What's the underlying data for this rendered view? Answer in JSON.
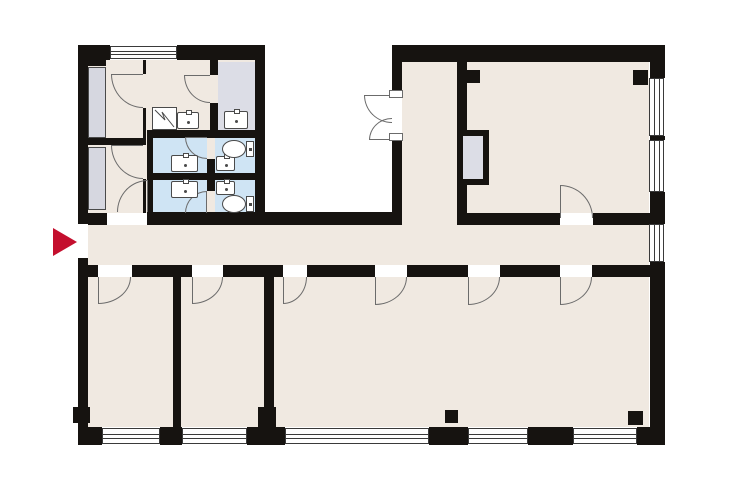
{
  "meta": {
    "title": "office-floor-plan",
    "canvas": {
      "w": 740,
      "h": 493
    }
  },
  "palette": {
    "wall": "#161310",
    "floor": "#f0e9e1",
    "wet": "#cfe4f4",
    "gray": "#dcdde6",
    "cabinet": "#d6d7e0",
    "outline": "#6b6b6b",
    "window_line": "#3a3a3a",
    "fixture": "#4a4a4a",
    "arrow": "#c40f2e",
    "white": "#ffffff"
  },
  "rooms": [
    {
      "name": "wing-a-floor",
      "x": 88,
      "y": 60,
      "w": 167,
      "h": 153,
      "fill": "floor"
    },
    {
      "name": "gray-washroom",
      "x": 218,
      "y": 62,
      "w": 37,
      "h": 68,
      "fill": "gray"
    },
    {
      "name": "wc-anteroom-1",
      "x": 153,
      "y": 138,
      "w": 54,
      "h": 35,
      "fill": "wet"
    },
    {
      "name": "wc-cabin-1",
      "x": 215,
      "y": 138,
      "w": 40,
      "h": 35,
      "fill": "wet"
    },
    {
      "name": "wc-anteroom-2",
      "x": 153,
      "y": 180,
      "w": 54,
      "h": 33,
      "fill": "wet"
    },
    {
      "name": "wc-cabin-2",
      "x": 215,
      "y": 180,
      "w": 40,
      "h": 33,
      "fill": "wet"
    },
    {
      "name": "north-lobby",
      "x": 402,
      "y": 62,
      "w": 55,
      "h": 163,
      "fill": "floor"
    },
    {
      "name": "meeting-room",
      "x": 467,
      "y": 62,
      "w": 182,
      "h": 151,
      "fill": "floor"
    },
    {
      "name": "corridor",
      "x": 88,
      "y": 225,
      "w": 561,
      "h": 40,
      "fill": "floor"
    },
    {
      "name": "office-1",
      "x": 88,
      "y": 277,
      "w": 85,
      "h": 150,
      "fill": "floor"
    },
    {
      "name": "office-2",
      "x": 181,
      "y": 277,
      "w": 83,
      "h": 150,
      "fill": "floor"
    },
    {
      "name": "open-office",
      "x": 274,
      "y": 277,
      "w": 375,
      "h": 150,
      "fill": "floor"
    }
  ],
  "walls": [
    [
      78,
      45,
      10,
      179
    ],
    [
      78,
      258,
      10,
      187
    ],
    [
      78,
      45,
      28,
      21
    ],
    [
      78,
      45,
      32,
      15
    ],
    [
      177,
      45,
      88,
      15
    ],
    [
      255,
      45,
      10,
      180
    ],
    [
      392,
      45,
      10,
      50
    ],
    [
      392,
      140,
      10,
      85
    ],
    [
      392,
      45,
      273,
      17
    ],
    [
      650,
      45,
      15,
      33
    ],
    [
      650,
      136,
      15,
      4
    ],
    [
      650,
      192,
      15,
      32
    ],
    [
      650,
      262,
      15,
      183
    ],
    [
      78,
      213,
      29,
      12
    ],
    [
      150,
      212,
      242,
      13
    ],
    [
      457,
      62,
      10,
      68
    ],
    [
      457,
      185,
      10,
      40
    ],
    [
      457,
      213,
      103,
      12
    ],
    [
      593,
      213,
      57,
      12
    ],
    [
      78,
      265,
      20,
      12
    ],
    [
      132,
      265,
      60,
      12
    ],
    [
      223,
      265,
      60,
      12
    ],
    [
      307,
      265,
      68,
      12
    ],
    [
      407,
      265,
      61,
      12
    ],
    [
      500,
      265,
      60,
      12
    ],
    [
      592,
      265,
      73,
      12
    ],
    [
      173,
      277,
      8,
      150
    ],
    [
      264,
      277,
      10,
      150
    ],
    [
      78,
      427,
      24,
      18
    ],
    [
      160,
      427,
      22,
      18
    ],
    [
      247,
      427,
      38,
      18
    ],
    [
      429,
      427,
      39,
      18
    ],
    [
      528,
      427,
      45,
      18
    ],
    [
      637,
      427,
      28,
      18
    ],
    [
      147,
      130,
      118,
      8
    ],
    [
      147,
      138,
      6,
      87
    ],
    [
      207,
      130,
      8,
      7
    ],
    [
      207,
      159,
      8,
      32
    ],
    [
      207,
      213,
      8,
      12
    ],
    [
      147,
      173,
      118,
      7
    ],
    [
      210,
      60,
      8,
      15
    ],
    [
      210,
      103,
      8,
      27
    ],
    [
      143,
      60,
      3,
      14
    ],
    [
      143,
      108,
      3,
      37
    ],
    [
      143,
      179,
      3,
      34
    ],
    [
      78,
      138,
      65,
      7
    ],
    [
      457,
      130,
      32,
      55
    ]
  ],
  "shaft_inner": [
    463,
    136,
    20,
    43
  ],
  "cabinets": [
    [
      88,
      67,
      18,
      71
    ],
    [
      88,
      147,
      18,
      63
    ]
  ],
  "openings": [
    [
      78,
      224,
      10,
      34
    ]
  ],
  "windows": [
    [
      110,
      46,
      67,
      13,
      "h"
    ],
    [
      649,
      78,
      15,
      58,
      "v"
    ],
    [
      649,
      140,
      15,
      52,
      "v"
    ],
    [
      649,
      224,
      15,
      38,
      "v"
    ],
    [
      102,
      428,
      58,
      16,
      "h"
    ],
    [
      182,
      428,
      65,
      16,
      "h"
    ],
    [
      285,
      428,
      144,
      16,
      "h"
    ],
    [
      468,
      428,
      60,
      16,
      "h"
    ],
    [
      573,
      428,
      64,
      16,
      "h"
    ]
  ],
  "doors": {
    "arcs": [
      [
        111,
        74,
        32,
        34,
        "tr"
      ],
      [
        111,
        145,
        32,
        34,
        "tr"
      ],
      [
        117,
        180,
        31,
        32,
        "br"
      ],
      [
        184,
        75,
        26,
        28,
        "tr"
      ],
      [
        185,
        137,
        22,
        22,
        "tr"
      ],
      [
        185,
        191,
        22,
        22,
        "br"
      ],
      [
        364,
        95,
        28,
        28,
        "tr"
      ],
      [
        369,
        118,
        23,
        22,
        "br"
      ],
      [
        560,
        185,
        33,
        33,
        "bl"
      ],
      [
        98,
        277,
        33,
        27,
        "tl"
      ],
      [
        192,
        277,
        31,
        27,
        "tl"
      ],
      [
        283,
        277,
        24,
        27,
        "tl"
      ],
      [
        375,
        277,
        32,
        28,
        "tl"
      ],
      [
        468,
        277,
        32,
        28,
        "tl"
      ],
      [
        560,
        277,
        32,
        28,
        "tl"
      ]
    ],
    "leaves": [
      [
        111,
        74,
        32,
        1
      ],
      [
        111,
        145,
        32,
        1
      ],
      [
        147,
        180,
        1,
        32
      ],
      [
        184,
        75,
        26,
        1
      ],
      [
        185,
        137,
        22,
        1
      ],
      [
        206,
        191,
        1,
        22
      ],
      [
        364,
        95,
        28,
        1
      ],
      [
        369,
        139,
        23,
        1
      ],
      [
        560,
        185,
        1,
        33
      ],
      [
        98,
        277,
        1,
        27
      ],
      [
        192,
        277,
        1,
        27
      ],
      [
        283,
        277,
        1,
        27
      ],
      [
        375,
        277,
        1,
        28
      ],
      [
        468,
        277,
        1,
        28
      ],
      [
        560,
        277,
        1,
        28
      ]
    ],
    "panels": [
      [
        389,
        90,
        14,
        8
      ],
      [
        389,
        133,
        14,
        8
      ]
    ]
  },
  "pillars": [
    [
      466,
      70,
      14,
      13
    ],
    [
      633,
      70,
      15,
      15
    ],
    [
      73,
      407,
      17,
      16
    ],
    [
      258,
      407,
      18,
      20
    ],
    [
      445,
      410,
      13,
      13
    ],
    [
      628,
      411,
      15,
      14
    ]
  ],
  "fixtures": {
    "sinks": [
      [
        177,
        112,
        22,
        17
      ],
      [
        224,
        111,
        24,
        18
      ],
      [
        171,
        155,
        27,
        17
      ],
      [
        216,
        156,
        19,
        15
      ],
      [
        171,
        181,
        27,
        17
      ],
      [
        216,
        181,
        19,
        14
      ]
    ],
    "toilets": [
      {
        "bowl": [
          222,
          140,
          24,
          18
        ],
        "tank": [
          246,
          141,
          8,
          16
        ]
      },
      {
        "bowl": [
          222,
          195,
          24,
          18
        ],
        "tank": [
          246,
          196,
          8,
          16
        ]
      }
    ],
    "mop_sinks": [
      [
        152,
        107,
        25,
        23
      ]
    ]
  },
  "entrance_arrow": {
    "x": 53,
    "y": 228,
    "w": 24,
    "h": 28
  }
}
